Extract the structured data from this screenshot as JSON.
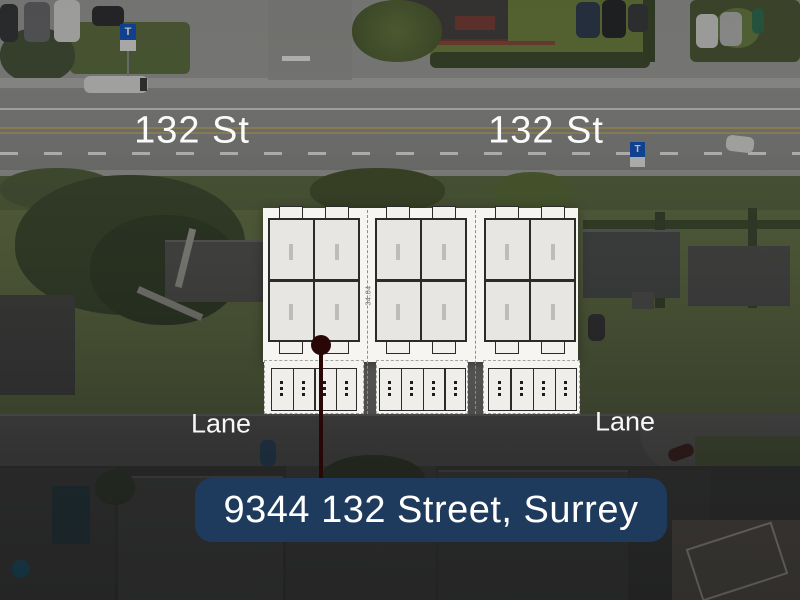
{
  "scene_type": "aerial-site-plan-marketing-image",
  "labels": {
    "street_left": "132 St",
    "street_right": "132 St",
    "lane_left": "Lane",
    "lane_right": "Lane"
  },
  "banner": {
    "text": "9344 132 Street, Surrey",
    "bg_color": "#1e3a5d",
    "text_color": "#ffffff"
  },
  "transit_sign": {
    "letter": "T",
    "bg_color": "#1256c4"
  },
  "site_plan": {
    "blocks": 3,
    "units_per_block": 4,
    "garage_bays_per_block": 4,
    "dimension_label": "34.04",
    "sheet_color": "#f6f5f2"
  },
  "marker": {
    "color": "#2a0707"
  }
}
